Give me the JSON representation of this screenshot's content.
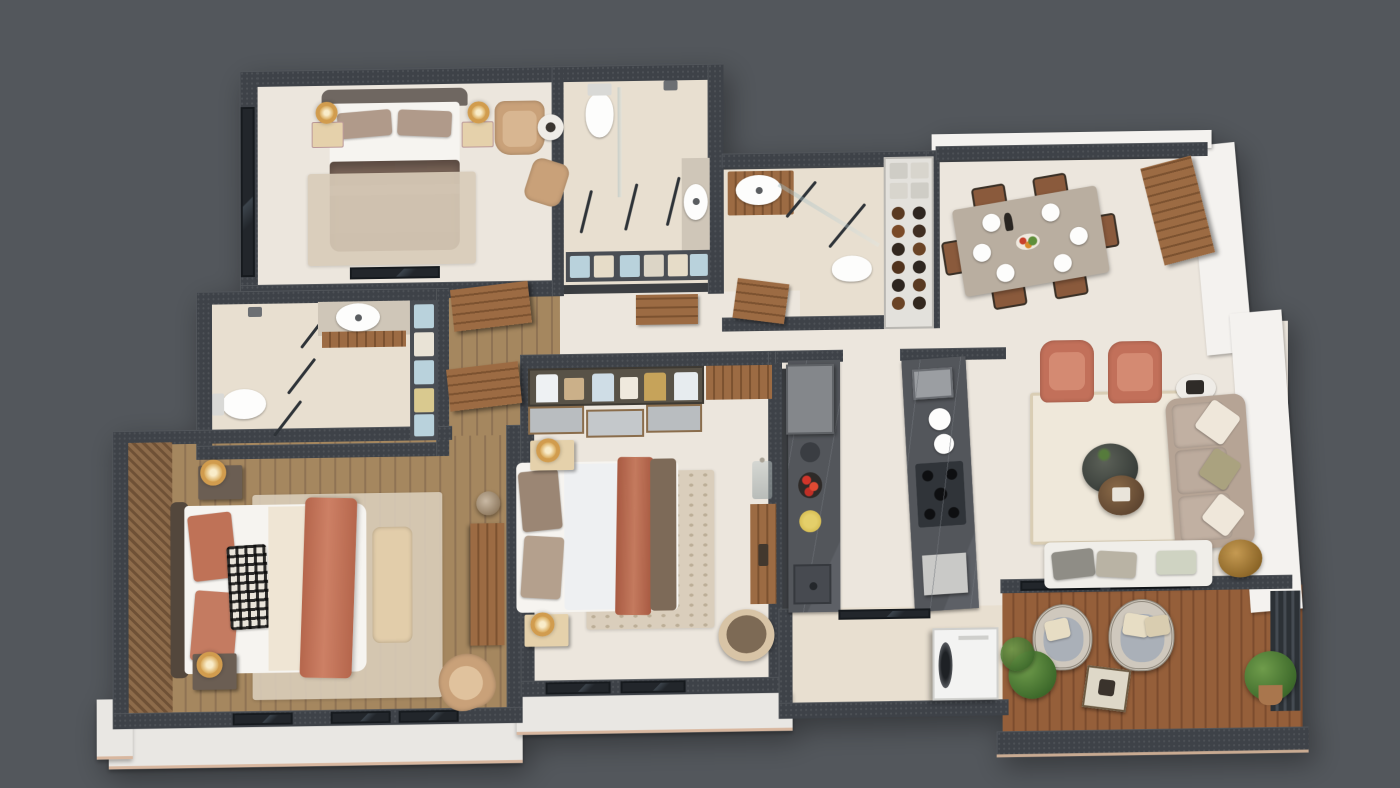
{
  "scene": {
    "type": "3d-apartment-floor-plan-render",
    "view": "top-down-axonometric",
    "text_visible": "none"
  },
  "palette": {
    "bg": "#53575c",
    "wall-dark": "#3e4248",
    "wall-white": "#f4f2ef",
    "ledge": "#e9e7e3",
    "ledge-edge": "#d8b79f",
    "floor-cream": "#ece6dd",
    "floor-tile": "#e8dfd0",
    "floor-wood": "#a5875f",
    "floor-deck": "#955f3a",
    "rug-beige": "#d8cbb8",
    "rug-ivory": "#efe8da",
    "bed-white": "#f6f4f0",
    "blanket-brown": "#786357",
    "blanket-rust": "#bf7257",
    "pillow-taupe": "#b09a8a",
    "headboard": "#6f6761",
    "wood": "#9c6b43",
    "wood-dark": "#7c5230",
    "nightstand-cream": "#e5d1ab",
    "nightstand-dark": "#6b5e53",
    "gold": "#d19c4e",
    "tan-chair": "#c9a179",
    "sofa-greige": "#b6a495",
    "rust-chair": "#c2705a",
    "counter-dark": "#53565b",
    "counter-vein": "#71757b",
    "appliance-gray": "#84878b",
    "white-goods": "#f3f3f2",
    "glass-edge": "#2e3338",
    "towel-blue": "#b9d2dc",
    "towel-cream": "#e6dcc8",
    "marble-light": "#cfc6b8",
    "table-marble": "#b9aea0",
    "chair-wood": "#8a5a3c",
    "wicker": "#cfc8bd",
    "wicker-cushion": "#aab0b8"
  },
  "rooms": [
    {
      "id": "master-bedroom",
      "furniture": [
        "double-bed",
        "area-rug",
        "nightstand-left",
        "nightstand-right",
        "ring-lamp",
        "armchair",
        "desk-chair",
        "side-table",
        "floor-windows"
      ]
    },
    {
      "id": "ensuite-bathroom",
      "furniture": [
        "toilet",
        "rain-shower",
        "glass-partition",
        "vanity-sink",
        "towel-shelf"
      ]
    },
    {
      "id": "family-bathroom",
      "furniture": [
        "vanity-sink",
        "glass-shower",
        "toilet",
        "wood-door",
        "pantry-shelf"
      ]
    },
    {
      "id": "guest-bathroom",
      "furniture": [
        "rain-shower",
        "glass-partition",
        "vanity-sink",
        "toilet",
        "towel-shelf"
      ]
    },
    {
      "id": "dining-room",
      "furniture": [
        "marble-dining-table",
        "six-chairs",
        "plates",
        "fruit-bowl",
        "wood-wall-panel"
      ]
    },
    {
      "id": "hallway",
      "furniture": [
        "wood-floor",
        "open-wood-doors"
      ]
    },
    {
      "id": "bedroom-2",
      "furniture": [
        "double-bed",
        "plaid-pillow",
        "foot-bench",
        "area-rug",
        "dark-nightstands",
        "ring-lamps",
        "swivel-chair",
        "wardrobe",
        "plant",
        "striped-accent-wall",
        "floor-windows"
      ]
    },
    {
      "id": "bedroom-3",
      "furniture": [
        "double-bed",
        "open-closet",
        "sliding-door-closet",
        "cream-nightstands",
        "ring-lamps",
        "area-rug",
        "papasan-chair",
        "console-table",
        "vase"
      ]
    },
    {
      "id": "kitchen",
      "furniture": [
        "fridge",
        "island-counter",
        "canister",
        "fruit-tray",
        "yellow-bowl",
        "under-mount-sink",
        "hob-counter",
        "coffee-machine",
        "plates",
        "gas-hob"
      ]
    },
    {
      "id": "laundry",
      "furniture": [
        "washing-machine",
        "glass-door"
      ]
    },
    {
      "id": "living-room",
      "furniture": [
        "three-seat-sofa",
        "two-rust-armchairs",
        "daybed",
        "round-coffee-tables",
        "white-side-table",
        "gold-side-table",
        "bordered-rug"
      ]
    },
    {
      "id": "balcony",
      "furniture": [
        "two-wicker-chairs",
        "square-table",
        "potted-plants",
        "wood-deck",
        "parapet-wall",
        "slat-screen"
      ]
    }
  ]
}
